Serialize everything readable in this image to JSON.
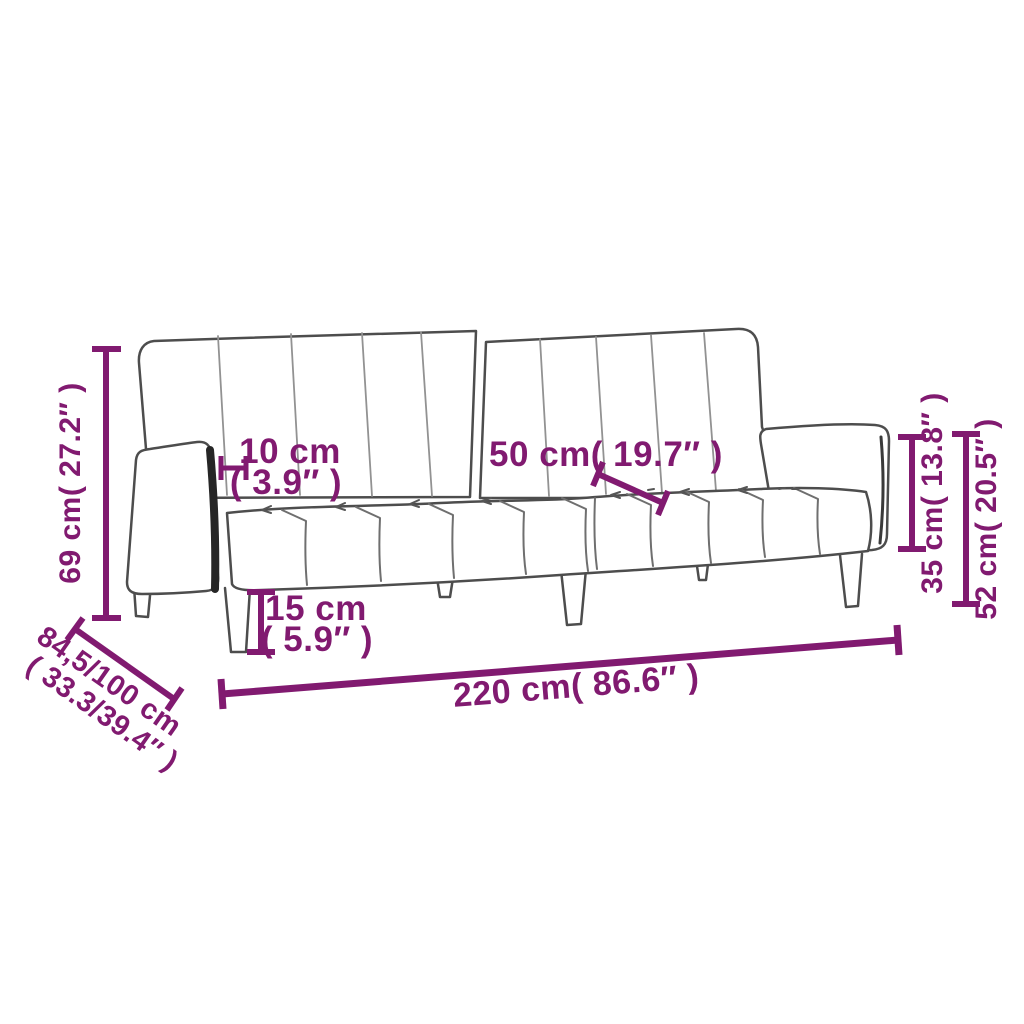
{
  "colors": {
    "dimension_annotation": "#811a70",
    "sofa_outline": "#4d4d4d",
    "sofa_channel": "#929292",
    "sofa_seat_channel": "#6f6f6f",
    "sofa_detail": "#555555",
    "sofa_edge_dark": "#262626",
    "background": "#ffffff"
  },
  "dimensions": {
    "total_height": {
      "label": "69 cm( 27.2″ )"
    },
    "armrest_thickness": {
      "line1": "10 cm",
      "line2": "( 3.9″ )"
    },
    "seat_depth": {
      "label": "50 cm( 19.7″ )"
    },
    "leg_height": {
      "line1": "15 cm",
      "line2": "( 5.9″ )"
    },
    "armrest_height": {
      "label": "35 cm( 13.8″ )"
    },
    "seat_height": {
      "label": "52 cm( 20.5″ )"
    },
    "total_width": {
      "label": "220 cm( 86.6″ )"
    },
    "total_depth": {
      "line1": "84,5/100 cm",
      "line2": "( 33.3/39.4″ )"
    }
  }
}
